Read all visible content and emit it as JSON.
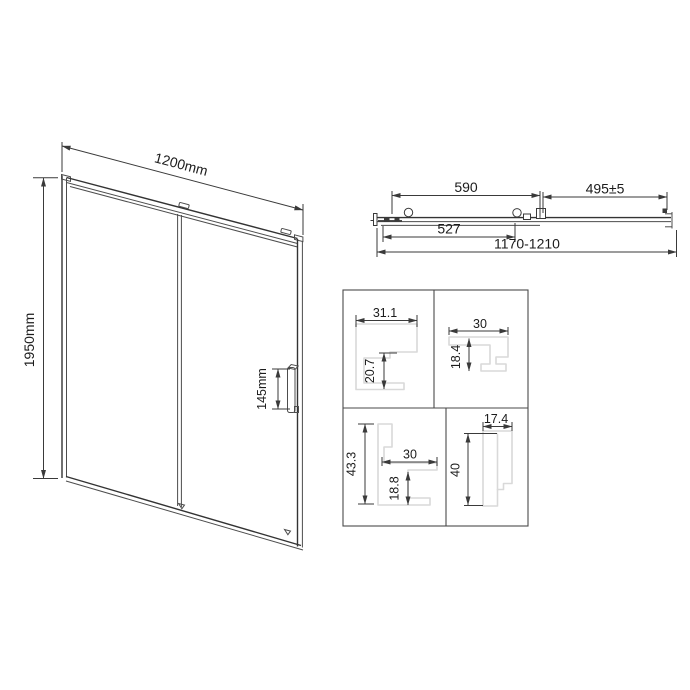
{
  "front_view": {
    "width_dim": "1200mm",
    "height_dim": "1950mm",
    "handle_dim": "145mm"
  },
  "top_view": {
    "panel_dim": "590",
    "entry_dim": "495±5",
    "glass_dim": "527",
    "range_dim": "1170-1210"
  },
  "profiles": {
    "wall_profile": {
      "width": "31.1",
      "depth": "20.7"
    },
    "top_rail_profile": {
      "width": "30",
      "depth": "18.4"
    },
    "bottom_rail_profile": {
      "height": "43.3",
      "width": "30",
      "depth": "18.8"
    },
    "vertical_profile": {
      "width": "17.4",
      "height": "40"
    }
  },
  "colors": {
    "line": "#3a3a3a",
    "profile_outline": "#d9d9d9",
    "background": "#ffffff"
  }
}
